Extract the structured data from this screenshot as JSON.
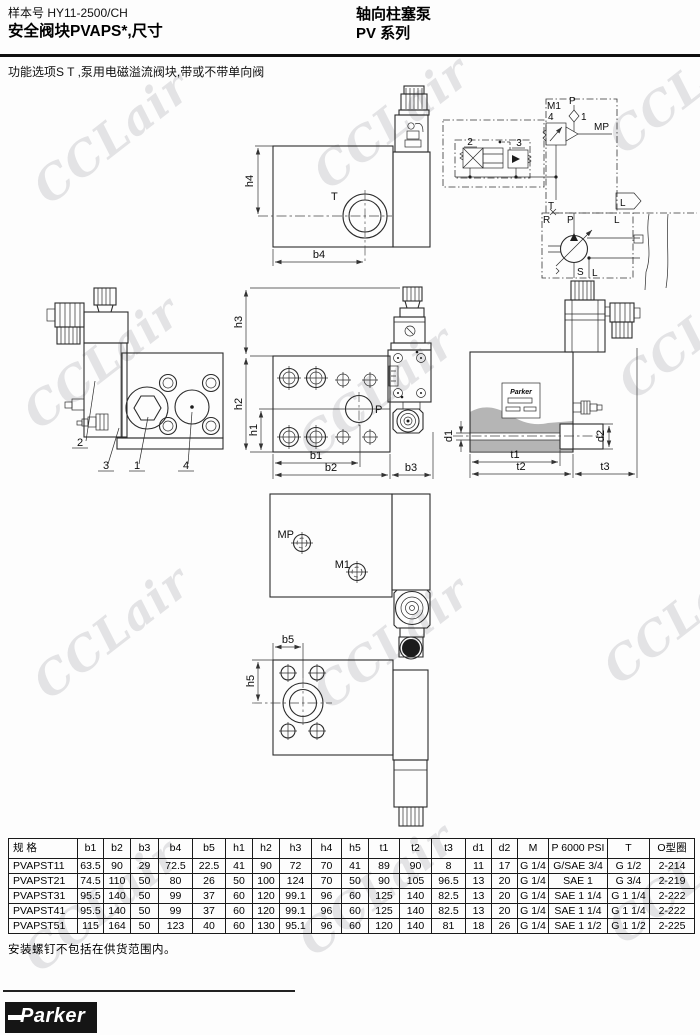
{
  "header": {
    "doc_no": "样本号 HY11-2500/CH",
    "title": "安全阀块PVAPS*,尺寸",
    "product": "轴向柱塞泵",
    "series": "PV 系列"
  },
  "intro": "功能选项S T ,泵用电磁溢流阀块,带或不带单向阀",
  "watermark": "CCLair",
  "labels": {
    "top": {
      "t": "T",
      "h4": "h4",
      "b4": "b4"
    },
    "sch": {
      "m1": "M1",
      "p": "P",
      "n4": "4",
      "n1": "1",
      "mp": "MP",
      "n2": "2",
      "n3": "3",
      "t": "T",
      "l_flag": "L",
      "r": "R",
      "p2": "P",
      "l2": "L",
      "s": "S",
      "l3": "L"
    },
    "front": {
      "c2": "2",
      "c3": "3",
      "c1": "1",
      "c4": "4"
    },
    "center": {
      "h3": "h3",
      "h2": "h2",
      "h1": "h1",
      "b1": "b1",
      "b2": "b2",
      "b3": "b3",
      "p": "P"
    },
    "side": {
      "d1": "d1",
      "d2": "d2",
      "t1": "t1",
      "t2": "t2",
      "t3": "t3",
      "plate": "Parker"
    },
    "ports": {
      "mp": "MP",
      "m1": "M1"
    },
    "bottom": {
      "b5": "b5",
      "h5": "h5"
    }
  },
  "table": {
    "headers": [
      "规 格",
      "b1",
      "b2",
      "b3",
      "b4",
      "b5",
      "h1",
      "h2",
      "h3",
      "h4",
      "h5",
      "t1",
      "t2",
      "t3",
      "d1",
      "d2",
      "M",
      "P 6000 PSI",
      "T",
      "O型圈"
    ],
    "rows": [
      [
        "PVAPST11",
        "63.5",
        "90",
        "29",
        "72.5",
        "22.5",
        "41",
        "90",
        "72",
        "70",
        "41",
        "89",
        "90",
        "8",
        "11",
        "17",
        "G 1/4",
        "G/SAE 3/4",
        "G 1/2",
        "2-214"
      ],
      [
        "PVAPST21",
        "74.5",
        "110",
        "50",
        "80",
        "26",
        "50",
        "100",
        "124",
        "70",
        "50",
        "90",
        "105",
        "96.5",
        "13",
        "20",
        "G 1/4",
        "SAE 1",
        "G 3/4",
        "2-219"
      ],
      [
        "PVAPST31",
        "95.5",
        "140",
        "50",
        "99",
        "37",
        "60",
        "120",
        "99.1",
        "96",
        "60",
        "125",
        "140",
        "82.5",
        "13",
        "20",
        "G 1/4",
        "SAE 1 1/4",
        "G 1 1/4",
        "2-222"
      ],
      [
        "PVAPST41",
        "95.5",
        "140",
        "50",
        "99",
        "37",
        "60",
        "120",
        "99.1",
        "96",
        "60",
        "125",
        "140",
        "82.5",
        "13",
        "20",
        "G 1/4",
        "SAE 1 1/4",
        "G 1 1/4",
        "2-222"
      ],
      [
        "PVAPST51",
        "115",
        "164",
        "50",
        "123",
        "40",
        "60",
        "130",
        "95.1",
        "96",
        "60",
        "120",
        "140",
        "81",
        "18",
        "26",
        "G 1/4",
        "SAE 1 1/2",
        "G 1 1/2",
        "2-225"
      ]
    ]
  },
  "note": "安装螺钉不包括在供货范围内。",
  "logo": "Parker"
}
